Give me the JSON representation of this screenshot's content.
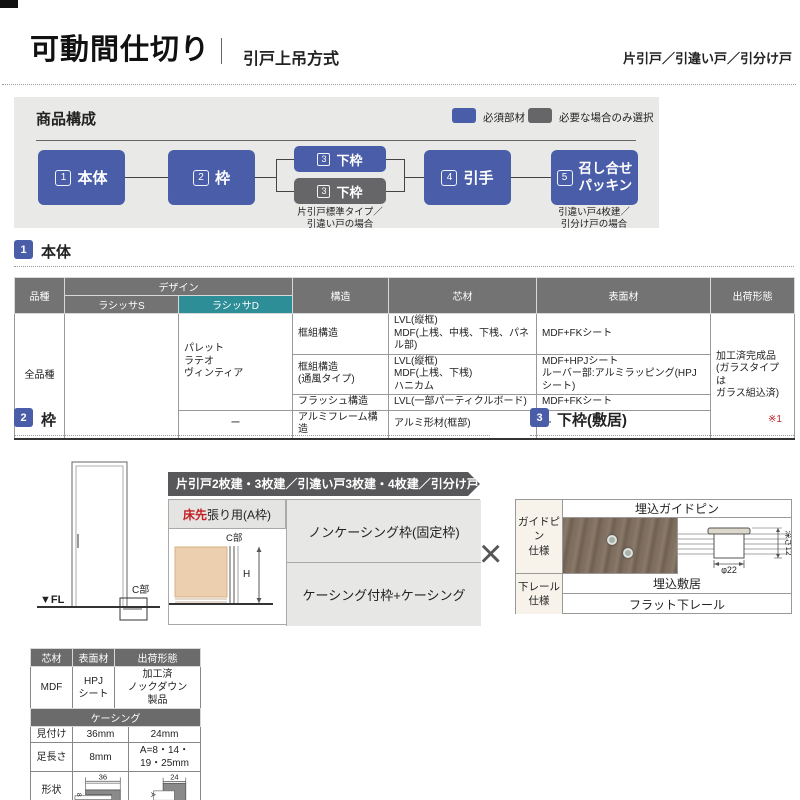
{
  "header": {
    "title": "可動間仕切り",
    "subtitle": "引戸上吊方式",
    "door_types": "片引戸／引違い戸／引分け戸"
  },
  "composition": {
    "title": "商品構成",
    "legend": {
      "required": "必須部材",
      "optional": "必要な場合のみ選択"
    },
    "nodes": {
      "n1": {
        "num": "1",
        "label": "本体"
      },
      "n2": {
        "num": "2",
        "label": "枠"
      },
      "n3a": {
        "num": "3",
        "label": "下枠"
      },
      "n3b": {
        "num": "3",
        "label": "下枠",
        "caption": "片引戸標準タイプ／\n引違い戸の場合"
      },
      "n4": {
        "num": "4",
        "label": "引手"
      },
      "n5": {
        "num": "5",
        "label": "召し合せ\nパッキン",
        "caption": "引違い戸4枚建／\n引分け戸の場合"
      }
    }
  },
  "section_body": {
    "num": "1",
    "title": "本体",
    "table": {
      "h_kind": "品種",
      "h_design": "デザイン",
      "h_lasissa_s": "ラシッサS",
      "h_lasissa_d": "ラシッサD",
      "h_structure": "構造",
      "h_core": "芯材",
      "h_surface": "表面材",
      "h_shipping": "出荷形態",
      "kind": "全品種",
      "design_d": "パレット\nラテオ\nヴィンティア",
      "design_d_last": "ー",
      "rows": [
        {
          "structure": "框組構造",
          "core": "LVL(縦框)\nMDF(上桟、中桟、下桟、パネル部)",
          "surface": "MDF+FKシート"
        },
        {
          "structure": "框組構造\n(通風タイプ)",
          "core": "LVL(縦框)\nMDF(上桟、下桟)\nハニカム",
          "surface": "MDF+HPJシート\nルーバー部:アルミラッピング(HPJシート)"
        },
        {
          "structure": "フラッシュ構造",
          "core": "LVL(一部パーティクルボード)",
          "surface": "MDF+FKシート"
        },
        {
          "structure": "アルミフレーム構造",
          "core": "アルミ形材(框部)",
          "surface": "ー"
        }
      ],
      "shipping": "加工済完成品\n(ガラスタイプは\nガラス組込済)"
    }
  },
  "section_frame": {
    "num": "2",
    "title": "枠",
    "banner": "片引戸2枚建・3枚建／引違い戸3枚建・4枚建／引分け戸",
    "floor_first_red": "床先",
    "floor_first_rest": "張り用(A枠)",
    "option1": "ノンケーシング枠(固定枠)",
    "option2": "ケーシング付枠+ケーシング",
    "multiply": "×",
    "diagram": {
      "fl": "▼FL",
      "c_label": "C部",
      "c_label2": "C部",
      "h_label": "H"
    }
  },
  "section_sill": {
    "num": "3",
    "title": "下枠(敷居)",
    "note": "※1",
    "rows": {
      "guide_label": "ガイドピン\n仕様",
      "guide_value": "埋込ガイドピン",
      "rail_label": "下レール\n仕様",
      "rail_value1": "埋込敷居",
      "rail_value2": "フラット下レール"
    },
    "diagram": {
      "dia": "φ22",
      "depth": "深さ12"
    }
  },
  "casing_tables": {
    "material": {
      "h_core": "芯材",
      "h_surface": "表面材",
      "h_shipping": "出荷形態",
      "core": "MDF",
      "surface": "HPJ\nシート",
      "shipping": "加工済\nノックダウン\n製品"
    },
    "casing": {
      "title": "ケーシング",
      "r1_label": "見付け",
      "r1_v1": "36mm",
      "r1_v2": "24mm",
      "r2_label": "足長さ",
      "r2_v1": "8mm",
      "r2_v2": "A=8・14・19・25mm",
      "r3_label": "形状",
      "dim1": "36",
      "dim1b": "8",
      "dim2": "24",
      "dim2b": "A"
    }
  },
  "colors": {
    "required_blue": "#4a5da8",
    "optional_gray": "#666668",
    "lasissa_d_teal": "#2e8e98",
    "accent_red": "#c21f24",
    "banner_gray": "#58585a"
  }
}
